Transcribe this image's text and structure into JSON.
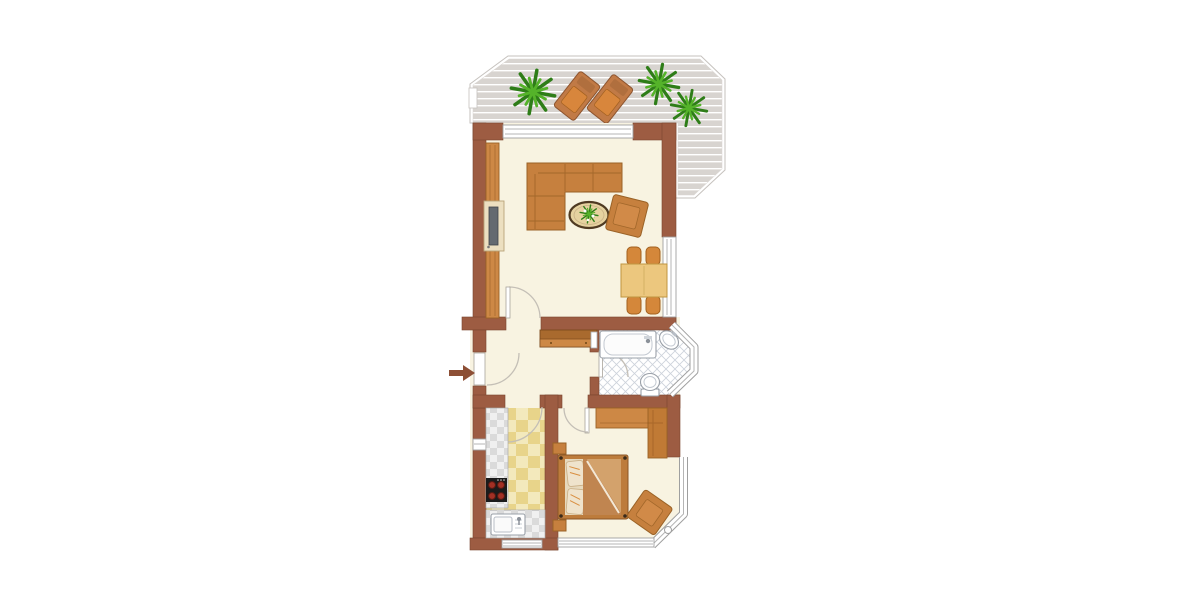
{
  "scene": {
    "kind": "apartment-floor-plan",
    "visible_text": "",
    "orientation": "vertical plan centered on white canvas"
  },
  "colors": {
    "wall": "#9d5c42",
    "wallEdge": "#7a452e",
    "floor": "#f8f3e1",
    "deck": "#d8d4d0",
    "deckLine": "#ffffff",
    "railEdge": "#c6c2be",
    "wood": "#c6803e",
    "woodEdge": "#9a6226",
    "woodLight": "#d18a48",
    "cabinet": "#cd8845",
    "cabinetDark": "#c07a35",
    "tableWood": "#ecc77e",
    "chairOrange": "#d4873a",
    "plantDark": "#2e7d18",
    "plantLight": "#55b32a",
    "fixtureStroke": "#9aa0a8",
    "tileLine": "#ccd2db",
    "kitchenTile1": "#f3e9bc",
    "kitchenTile2": "#e8d48a",
    "counter1": "#f0f0f0",
    "counter2": "#dadada",
    "stove": "#1b1b1b",
    "burner": "#a33024",
    "duvet": "#c08550",
    "duvetLight": "#d3a26c",
    "pillow": "#efe3cc",
    "mattress": "#e7d9bd",
    "tvScreen": "#646a70",
    "arrow": "#8d4f35",
    "windowEdge": "#9f9f9f",
    "glassLine": "#b5b5b5"
  },
  "rooms": [
    {
      "name": "terrace",
      "floor": "grey wood decking",
      "items": [
        "potted-plant x3",
        "sun-lounger x2",
        "railing",
        "railing-gate"
      ]
    },
    {
      "name": "living-room",
      "floor": "cream",
      "items": [
        "tv-sideboard",
        "corner-sofa",
        "coffee-table-with-plant",
        "armchair",
        "dining-table",
        "dining-chair x4",
        "window-top",
        "window-right",
        "door-to-hallway"
      ]
    },
    {
      "name": "hallway",
      "floor": "cream",
      "items": [
        "entrance-door",
        "entrance-arrow",
        "sideboard"
      ]
    },
    {
      "name": "bathroom",
      "floor": "white diamond tiles",
      "items": [
        "bathtub",
        "wall-mirror",
        "washbasin",
        "toilet",
        "bay-window",
        "door"
      ]
    },
    {
      "name": "kitchen",
      "floor": "yellow checker tiles",
      "items": [
        "counter-left",
        "stove-4-burners",
        "counter-bottom",
        "kitchen-sink",
        "window-left",
        "window-bottom",
        "door"
      ]
    },
    {
      "name": "bedroom",
      "floor": "cream",
      "items": [
        "double-bed",
        "nightstand x2",
        "wardrobe-l-shaped",
        "armchair",
        "window-right",
        "window-corner",
        "window-bottom",
        "door"
      ]
    }
  ]
}
